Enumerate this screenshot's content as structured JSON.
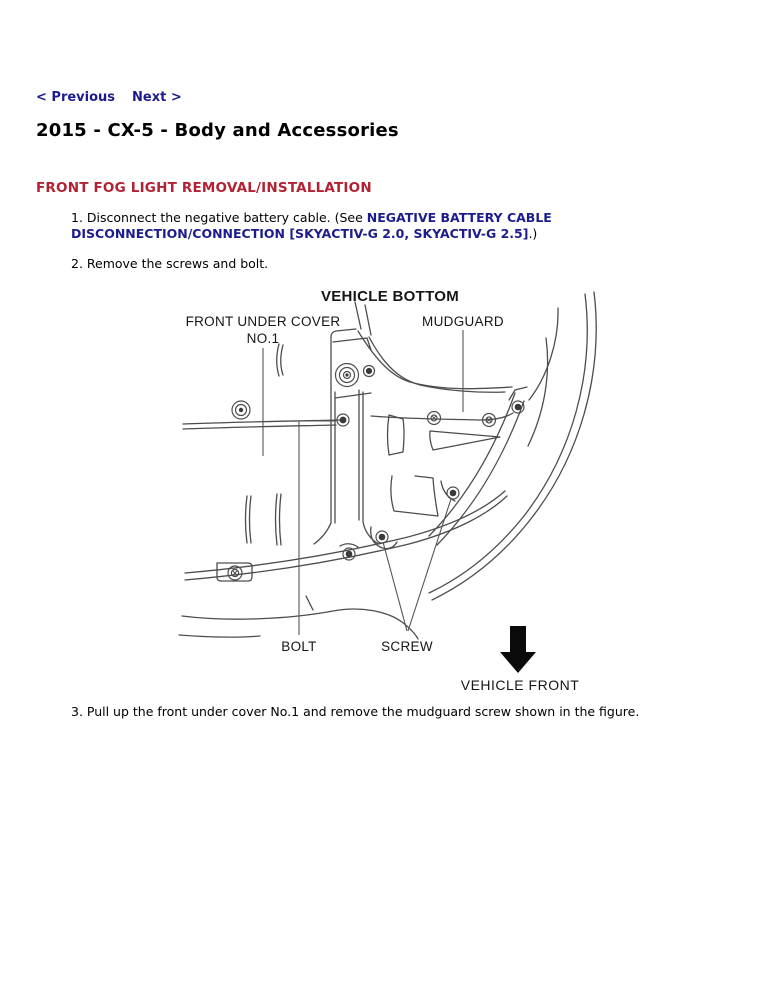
{
  "colors": {
    "link_navy": "#1c1c8c",
    "heading_red": "#b22233",
    "body_text": "#000000",
    "diagram_line": "#4d4d4d",
    "arrow_black": "#0a0a0a"
  },
  "nav": {
    "previous": "< Previous",
    "next": "Next >"
  },
  "doc": {
    "title": "2015 - CX-5 - Body and Accessories",
    "section_heading": "FRONT FOG LIGHT REMOVAL/INSTALLATION"
  },
  "steps": {
    "step1_before": "1. Disconnect the negative battery cable. (See ",
    "step1_link": "NEGATIVE BATTERY CABLE DISCONNECTION/CONNECTION [SKYACTIV-G 2.0, SKYACTIV-G 2.5]",
    "step1_after": ".)",
    "step2": "2. Remove the screws and bolt.",
    "step3": "3. Pull up the front under cover No.1 and remove the mudguard screw shown in the figure."
  },
  "figure": {
    "title": "VEHICLE BOTTOM",
    "label_front_under_cover": "FRONT UNDER COVER",
    "label_front_under_cover_no1": "NO.1",
    "label_mudguard": "MUDGUARD",
    "label_bolt": "BOLT",
    "label_screw": "SCREW",
    "label_vehicle_front": "VEHICLE FRONT"
  }
}
